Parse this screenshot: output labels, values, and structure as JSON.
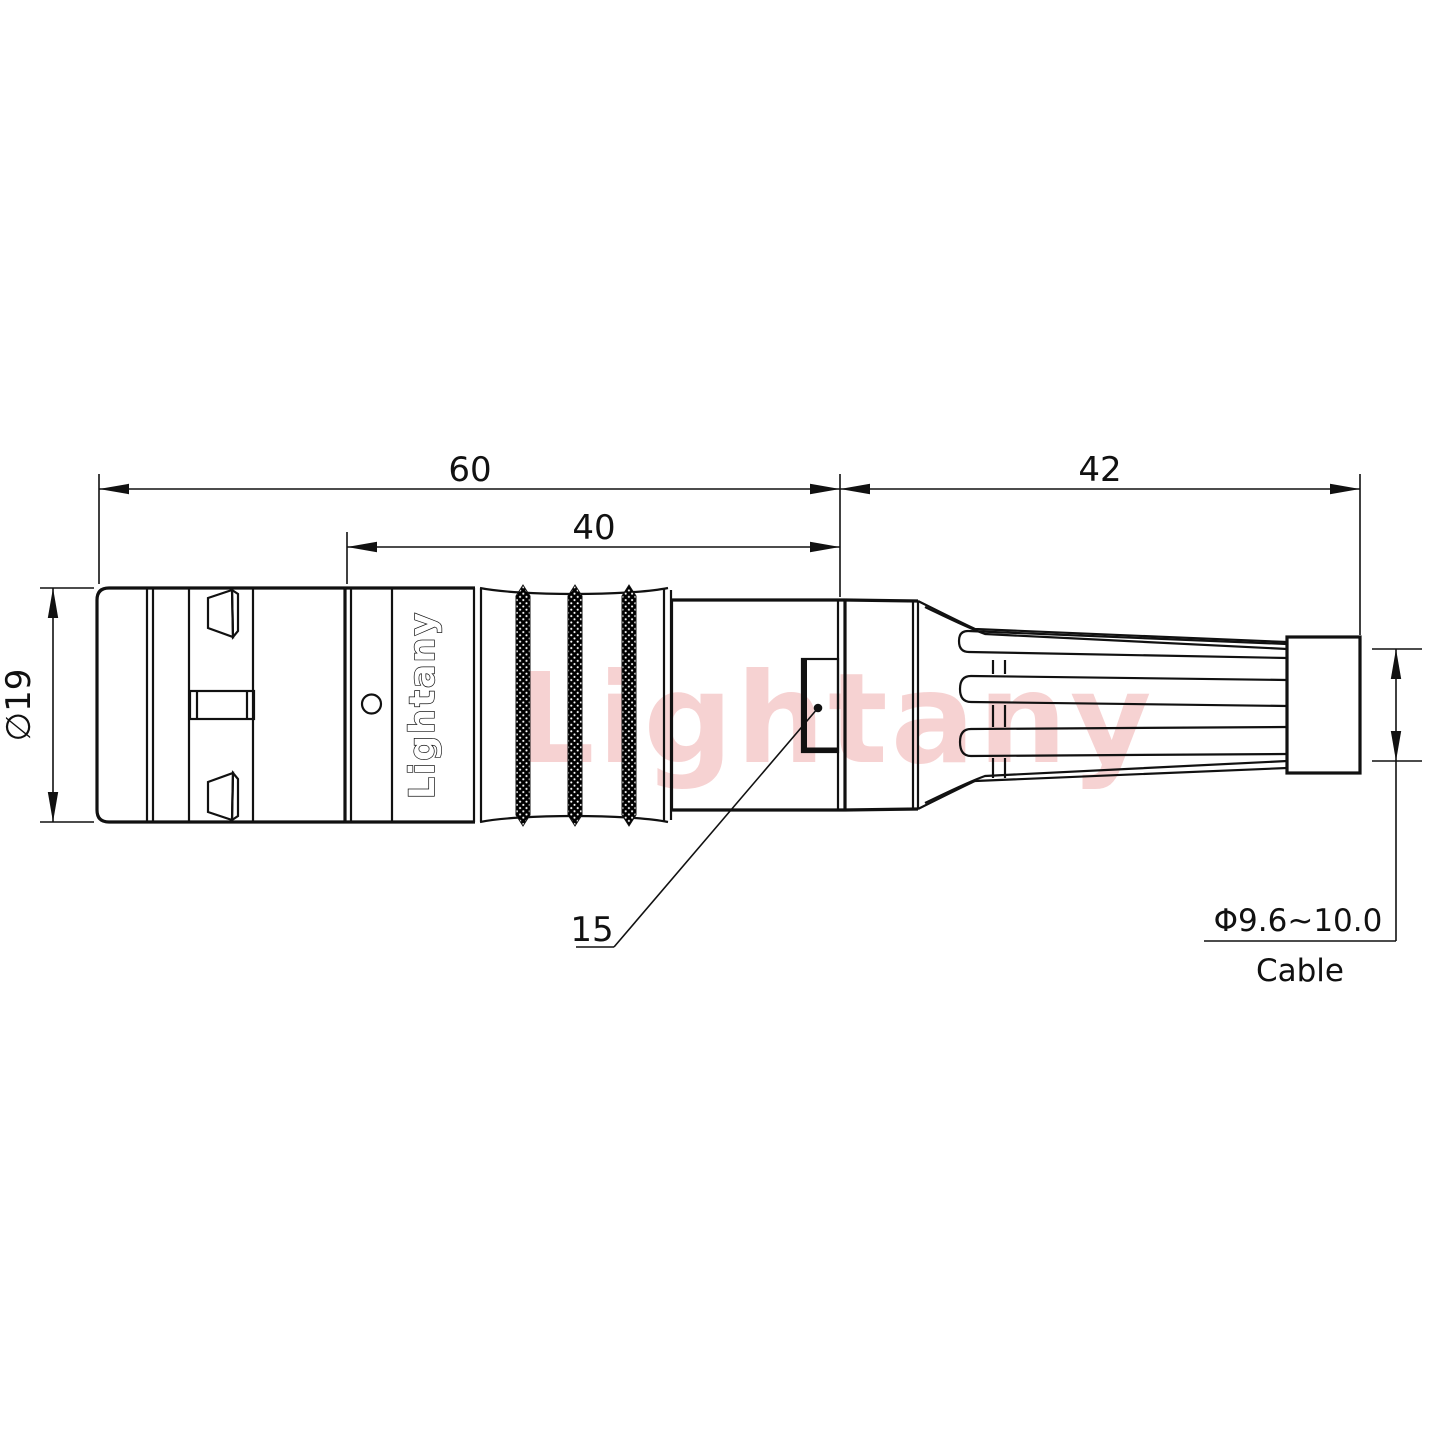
{
  "watermark_text": "Lightany",
  "connector": {
    "logo_text": "Lightany"
  },
  "dimensions": {
    "overall_length": "60",
    "mid_section_length": "40",
    "boot_length": "42",
    "body_diameter": "∅19",
    "latch_ref": "15",
    "cable_diameter_range": "Φ9.6~10.0",
    "cable_label": "Cable"
  },
  "colors": {
    "line": "#111111",
    "watermark_pink": "#f2b8b8",
    "background": "#ffffff",
    "knurl_fill": "#000000"
  }
}
